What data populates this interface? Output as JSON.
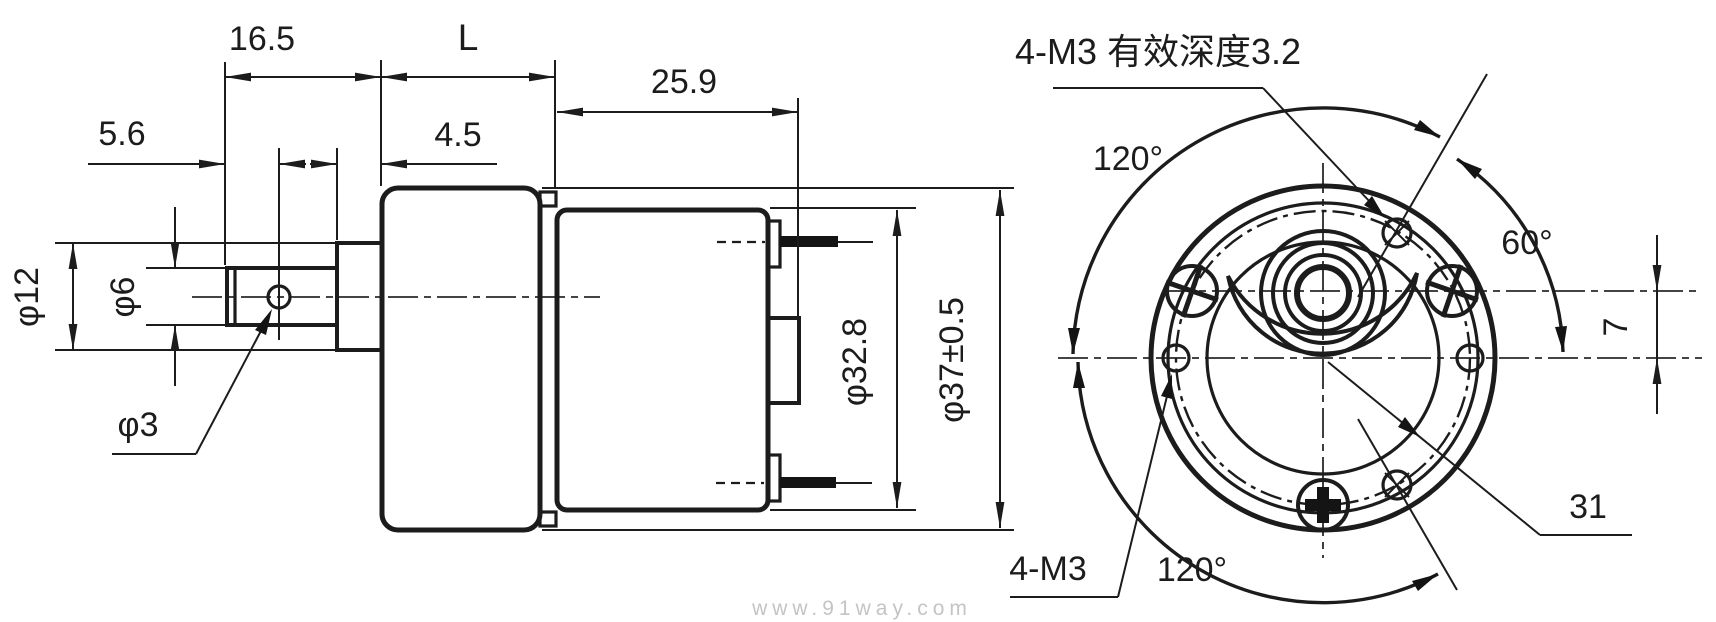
{
  "colors": {
    "line": "#1c1c1c",
    "watermark": "#c4c4c4",
    "background": "#ffffff"
  },
  "side_view": {
    "dim_5_6": "5.6",
    "dim_16_5": "16.5",
    "dim_L": "L",
    "dim_4_5": "4.5",
    "dim_25_9": "25.9",
    "dim_phi12": "φ12",
    "dim_phi6": "φ6",
    "dim_phi3": "φ3",
    "dim_phi32_8": "φ32.8",
    "dim_phi37": "φ37±0.5"
  },
  "front_view": {
    "label_m3_depth": "4-M3 有效深度3.2",
    "label_m3": "4-M3",
    "dim_120_top": "120°",
    "dim_120_bottom": "120°",
    "dim_60": "60°",
    "dim_31": "31",
    "dim_7": "7"
  },
  "watermark": "www.91way.com"
}
